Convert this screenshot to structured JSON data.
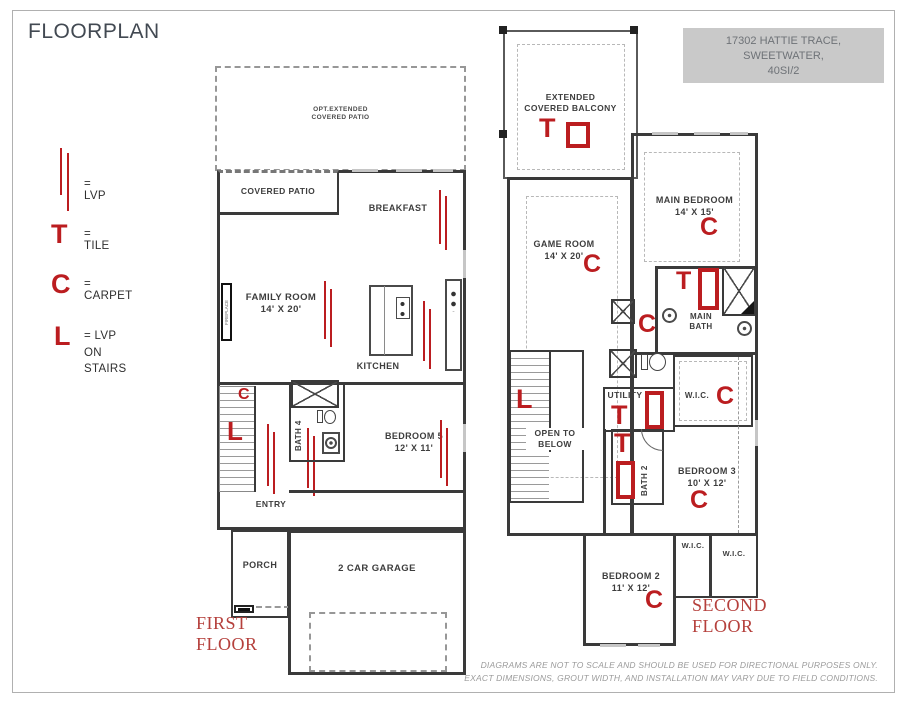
{
  "page": {
    "title": "FLOORPLAN",
    "info_box": {
      "line1": "17302 HATTIE TRACE,",
      "line2": "SWEETWATER,",
      "line3": "40SI/2"
    },
    "disclaimer": {
      "line1": "DIAGRAMS ARE NOT TO SCALE AND SHOULD BE USED FOR DIRECTIONAL PURPOSES ONLY.",
      "line2": "EXACT DIMENSIONS, GROUT WIDTH, AND INSTALLATION MAY VARY DUE TO FIELD CONDITIONS."
    }
  },
  "colors": {
    "marker_red": "#bb1d20",
    "floor_label_red": "#b5403c",
    "wall": "#3a3a3a",
    "info_box_bg": "#c9c9c9"
  },
  "legend": {
    "lvp_label": "= LVP",
    "tile_symbol": "T",
    "tile_label": "= TILE",
    "carpet_symbol": "C",
    "carpet_label": "= CARPET",
    "stairs_symbol": "L",
    "stairs_label_line1": "= LVP ON",
    "stairs_label_line2": "STAIRS"
  },
  "markers": {
    "tile": "T",
    "carpet": "C",
    "lvp_stairs": "L"
  },
  "first_floor": {
    "floor_label": "FIRST FLOOR",
    "opt_patio_line1": "OPT.EXTENDED",
    "opt_patio_line2": "COVERED PATIO",
    "covered_patio": "COVERED PATIO",
    "breakfast": "BREAKFAST",
    "family_room_name": "FAMILY ROOM",
    "family_room_dims": "14' X 20'",
    "fireplace": "FIREPLACE",
    "kitchen": "KITCHEN",
    "bath4": "BATH 4",
    "bedroom5_name": "BEDROOM 5",
    "bedroom5_dims": "12' X 11'",
    "entry": "ENTRY",
    "porch": "PORCH",
    "garage": "2 CAR GARAGE"
  },
  "second_floor": {
    "floor_label": "SECOND FLOOR",
    "balcony_line1": "EXTENDED",
    "balcony_line2": "COVERED BALCONY",
    "main_bedroom_name": "MAIN BEDROOM",
    "main_bedroom_dims": "14' X 15'",
    "game_room_name": "GAME ROOM",
    "game_room_dims": "14' X 20'",
    "main_bath_line1": "MAIN",
    "main_bath_line2": "BATH",
    "wic_main": "W.I.C.",
    "utility": "UTILITY",
    "open_line1": "OPEN TO",
    "open_line2": "BELOW",
    "bath2": "BATH 2",
    "bedroom3_name": "BEDROOM 3",
    "bedroom3_dims": "10' X 12'",
    "wic_left": "W.I.C.",
    "wic_right": "W.I.C.",
    "bedroom2_name": "BEDROOM 2",
    "bedroom2_dims": "11' X 12'"
  }
}
